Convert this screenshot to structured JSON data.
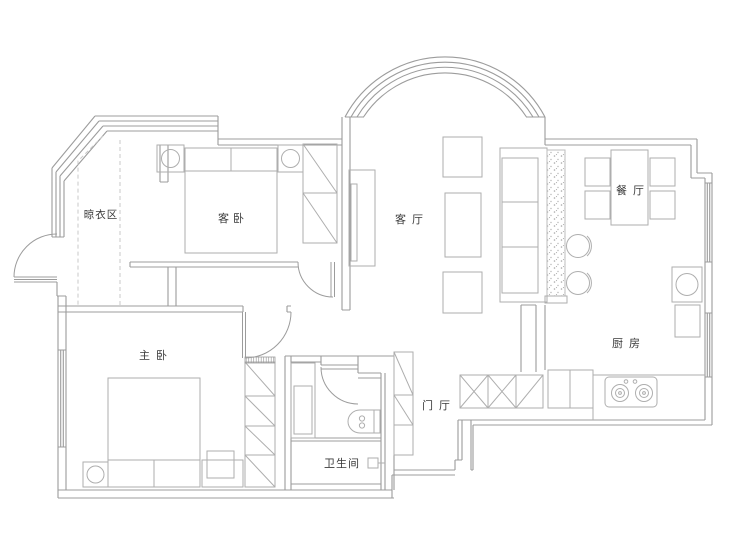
{
  "plan": {
    "rooms": [
      {
        "id": "drying-area",
        "label": "晾衣区"
      },
      {
        "id": "guest-bedroom",
        "label": "客卧"
      },
      {
        "id": "living-room",
        "label": "客厅"
      },
      {
        "id": "dining-room",
        "label": "餐厅"
      },
      {
        "id": "master-bedroom",
        "label": "主卧"
      },
      {
        "id": "kitchen",
        "label": "厨房"
      },
      {
        "id": "entrance-hall",
        "label": "门厅"
      },
      {
        "id": "bathroom",
        "label": "卫生间"
      }
    ],
    "colors": {
      "wall": "#9c9c9c",
      "furniture": "#aeaeae",
      "dashed": "#c8c8c8",
      "label": "#3a3a3a",
      "background": "#ffffff"
    }
  }
}
